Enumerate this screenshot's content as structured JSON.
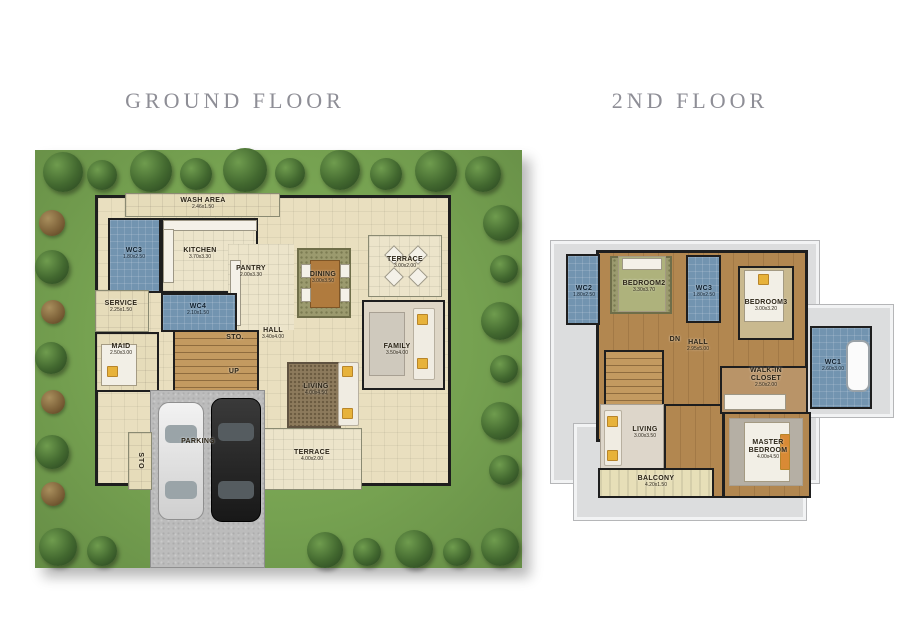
{
  "titles": {
    "ground": "GROUND FLOOR",
    "second": "2ND FLOOR"
  },
  "ground": {
    "rooms": [
      {
        "name": "WASH AREA",
        "dim": "2.46x1.50"
      },
      {
        "name": "WC3",
        "dim": "1.80x2.50"
      },
      {
        "name": "KITCHEN",
        "dim": "3.70x3.30"
      },
      {
        "name": "PANTRY",
        "dim": "2.00x3.30"
      },
      {
        "name": "DINING",
        "dim": "3.00x3.50"
      },
      {
        "name": "TERRACE",
        "dim": "3.00x2.00"
      },
      {
        "name": "SERVICE",
        "dim": "2.25x1.50"
      },
      {
        "name": "WC4",
        "dim": "2.10x1.50"
      },
      {
        "name": "MAID",
        "dim": "2.50x3.00"
      },
      {
        "name": "STO.",
        "dim": ""
      },
      {
        "name": "HALL",
        "dim": "3.40x4.00"
      },
      {
        "name": "UP",
        "dim": ""
      },
      {
        "name": "LIVING",
        "dim": "4.00x4.50"
      },
      {
        "name": "FAMILY",
        "dim": "3.50x4.00"
      },
      {
        "name": "TERRACE",
        "dim": "4.00x2.00"
      },
      {
        "name": "PARKING",
        "dim": ""
      },
      {
        "name": "STO",
        "dim": ""
      }
    ]
  },
  "second": {
    "rooms": [
      {
        "name": "WC2",
        "dim": "1.80x2.50"
      },
      {
        "name": "BEDROOM2",
        "dim": "3.30x3.70"
      },
      {
        "name": "WC3",
        "dim": "1.80x2.50"
      },
      {
        "name": "BEDROOM3",
        "dim": "3.00x3.20"
      },
      {
        "name": "HALL",
        "dim": "2.95x5.00"
      },
      {
        "name": "DN",
        "dim": ""
      },
      {
        "name": "WALK-IN CLOSET",
        "dim": "2.50x2.00"
      },
      {
        "name": "WC1",
        "dim": "2.60x3.00"
      },
      {
        "name": "LIVING",
        "dim": "3.00x3.50"
      },
      {
        "name": "MASTER BEDROOM",
        "dim": "4.00x4.50"
      },
      {
        "name": "BALCONY",
        "dim": "4.20x1.50"
      }
    ]
  },
  "colors": {
    "lawn": "#76a251",
    "floor": "#e9dfbf",
    "wc_tile": "#7294b0",
    "wood": "#b28750",
    "roof": "#dcddde",
    "title": "#8e8e96",
    "wall": "#1e1e1e"
  }
}
